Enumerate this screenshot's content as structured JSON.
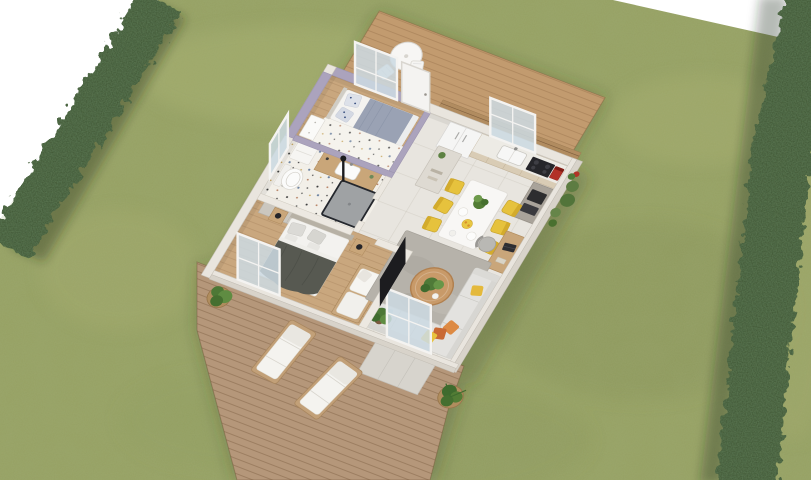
{
  "scene": {
    "type": "3d-floor-plan-render",
    "view": "top-down axonometric",
    "description": "Rendered aerial view of a small one-storey house interior set on a green lawn bordered by two clipped hedges, with a cafe terrace at the top and a sun deck with two loungers at the bottom"
  },
  "palette": {
    "bg": "#ffffff",
    "lawn": "#96a163",
    "lawn_light": "#b6bd7a",
    "lawn_dark": "#7c894f",
    "hedge": "#3c5232",
    "deck": "#b5977a",
    "deck_top": "#c29b6f",
    "wall": "#e9e5de",
    "wall_face": "#d8d3ca",
    "wall_lavender": "#aba3bd",
    "interior_wall": "#ece8e1",
    "tile_floor": "#e8e5df",
    "wood_floor": "#c9a77e",
    "cabinet": "#d9ccb5",
    "fridge": "#f5f5f4",
    "sofa": "#e3e2df",
    "rug": "#b6b2aa",
    "glass": "#ccdae2",
    "frame_white": "#f4f3f1",
    "tv": "#1c1c1f",
    "chair_yellow": "#e6c23d",
    "pillow_orange": "#dd8a43",
    "pillow_deep_orange": "#c96a35",
    "pillow_yellow": "#e8c33e",
    "pillow_blue": "#bcd3d8",
    "coffee_machine_red": "#b23127",
    "appliance_dark": "#26262a",
    "master_blanket": "#575951",
    "single_bed_blanket": "#9aa2b4",
    "bench_wood": "#c9a87f",
    "plant_green": "#4f7a38",
    "pot_rattan": "#b08d5e",
    "table_white": "#f8f7f5"
  },
  "objects": {
    "garden": [
      "lawn",
      "left-hedge",
      "right-hedge"
    ],
    "terraces": [
      "top-terrace",
      "bottom-deck",
      "concrete-pad"
    ],
    "top_terrace_items": [
      "bistro-table",
      "folding-chair",
      "folding-chair"
    ],
    "bottom_deck_items": [
      "sun-lounger",
      "sun-lounger",
      "potted-plant",
      "corner-potted-plant"
    ],
    "rooms": [
      "small-bedroom",
      "bathroom",
      "master-bedroom",
      "hallway",
      "kitchen",
      "dining-area",
      "living-room"
    ],
    "small_bedroom": [
      "single-bed",
      "patterned-pillows",
      "dresser",
      "terrazzo-rug",
      "window"
    ],
    "bathroom": [
      "vanity-sink",
      "toilet",
      "shower",
      "laundry-box",
      "window"
    ],
    "master_bedroom": [
      "double-bed",
      "nightstand-lamps",
      "wardrobe",
      "daybed-bench",
      "glass-door"
    ],
    "kitchen": [
      "fridge",
      "counter-sink",
      "cooktop",
      "coffee-machine",
      "oven-column",
      "window",
      "wood-slat-cladding"
    ],
    "dining_area": [
      "white-table",
      "yellow-chairs",
      "plant-centerpiece",
      "fruit-bowl",
      "hall-closet"
    ],
    "living_room": [
      "corner-sofa",
      "throw-pillows",
      "round-coffee-table",
      "gray-rug",
      "tv",
      "desk",
      "desk-chair",
      "indoor-plant",
      "glass-door"
    ]
  }
}
